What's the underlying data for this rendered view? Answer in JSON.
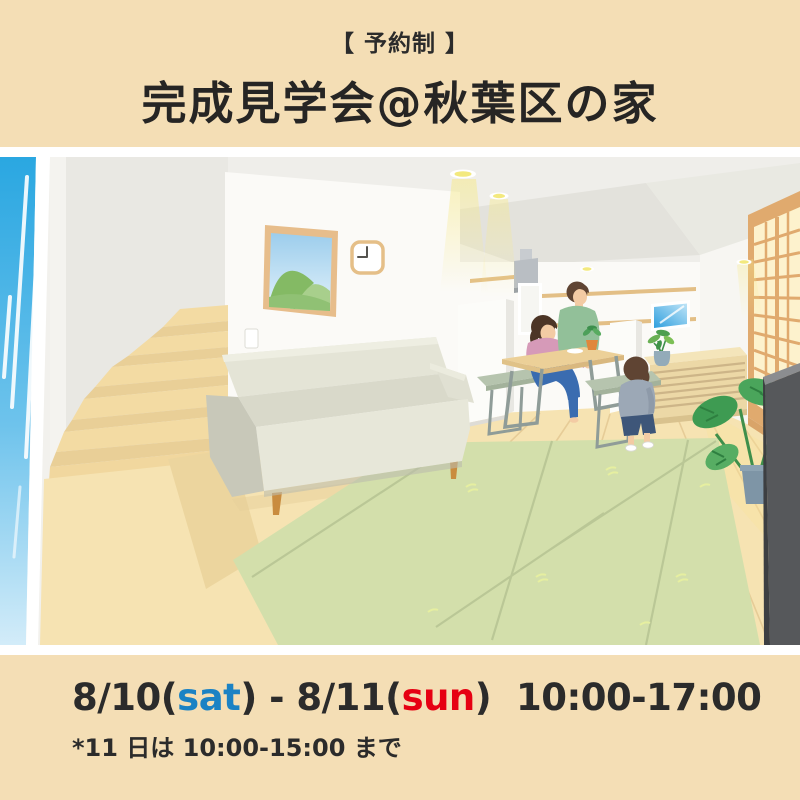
{
  "header": {
    "badge": "【 予約制 】",
    "title": "完成見学会@秋葉区の家"
  },
  "schedule": {
    "date1": "8/10(",
    "day1": "sat",
    "mid": ") - ",
    "date2": "8/11(",
    "day2": "sun",
    "after": ")  ",
    "time": "10:00-17:00",
    "note": "*11 日は 10:00-15:00 まで"
  },
  "colors": {
    "background_beige": "#f4deb5",
    "text_dark": "#2b2b2b",
    "saturday_blue": "#1b82c4",
    "sunday_red": "#e60012",
    "illustration_border": "#ffffff",
    "tatami_green": "#d3dfab",
    "floor_wood": "#f6e3b2",
    "window_sky_blue": "#2aa7e1"
  }
}
